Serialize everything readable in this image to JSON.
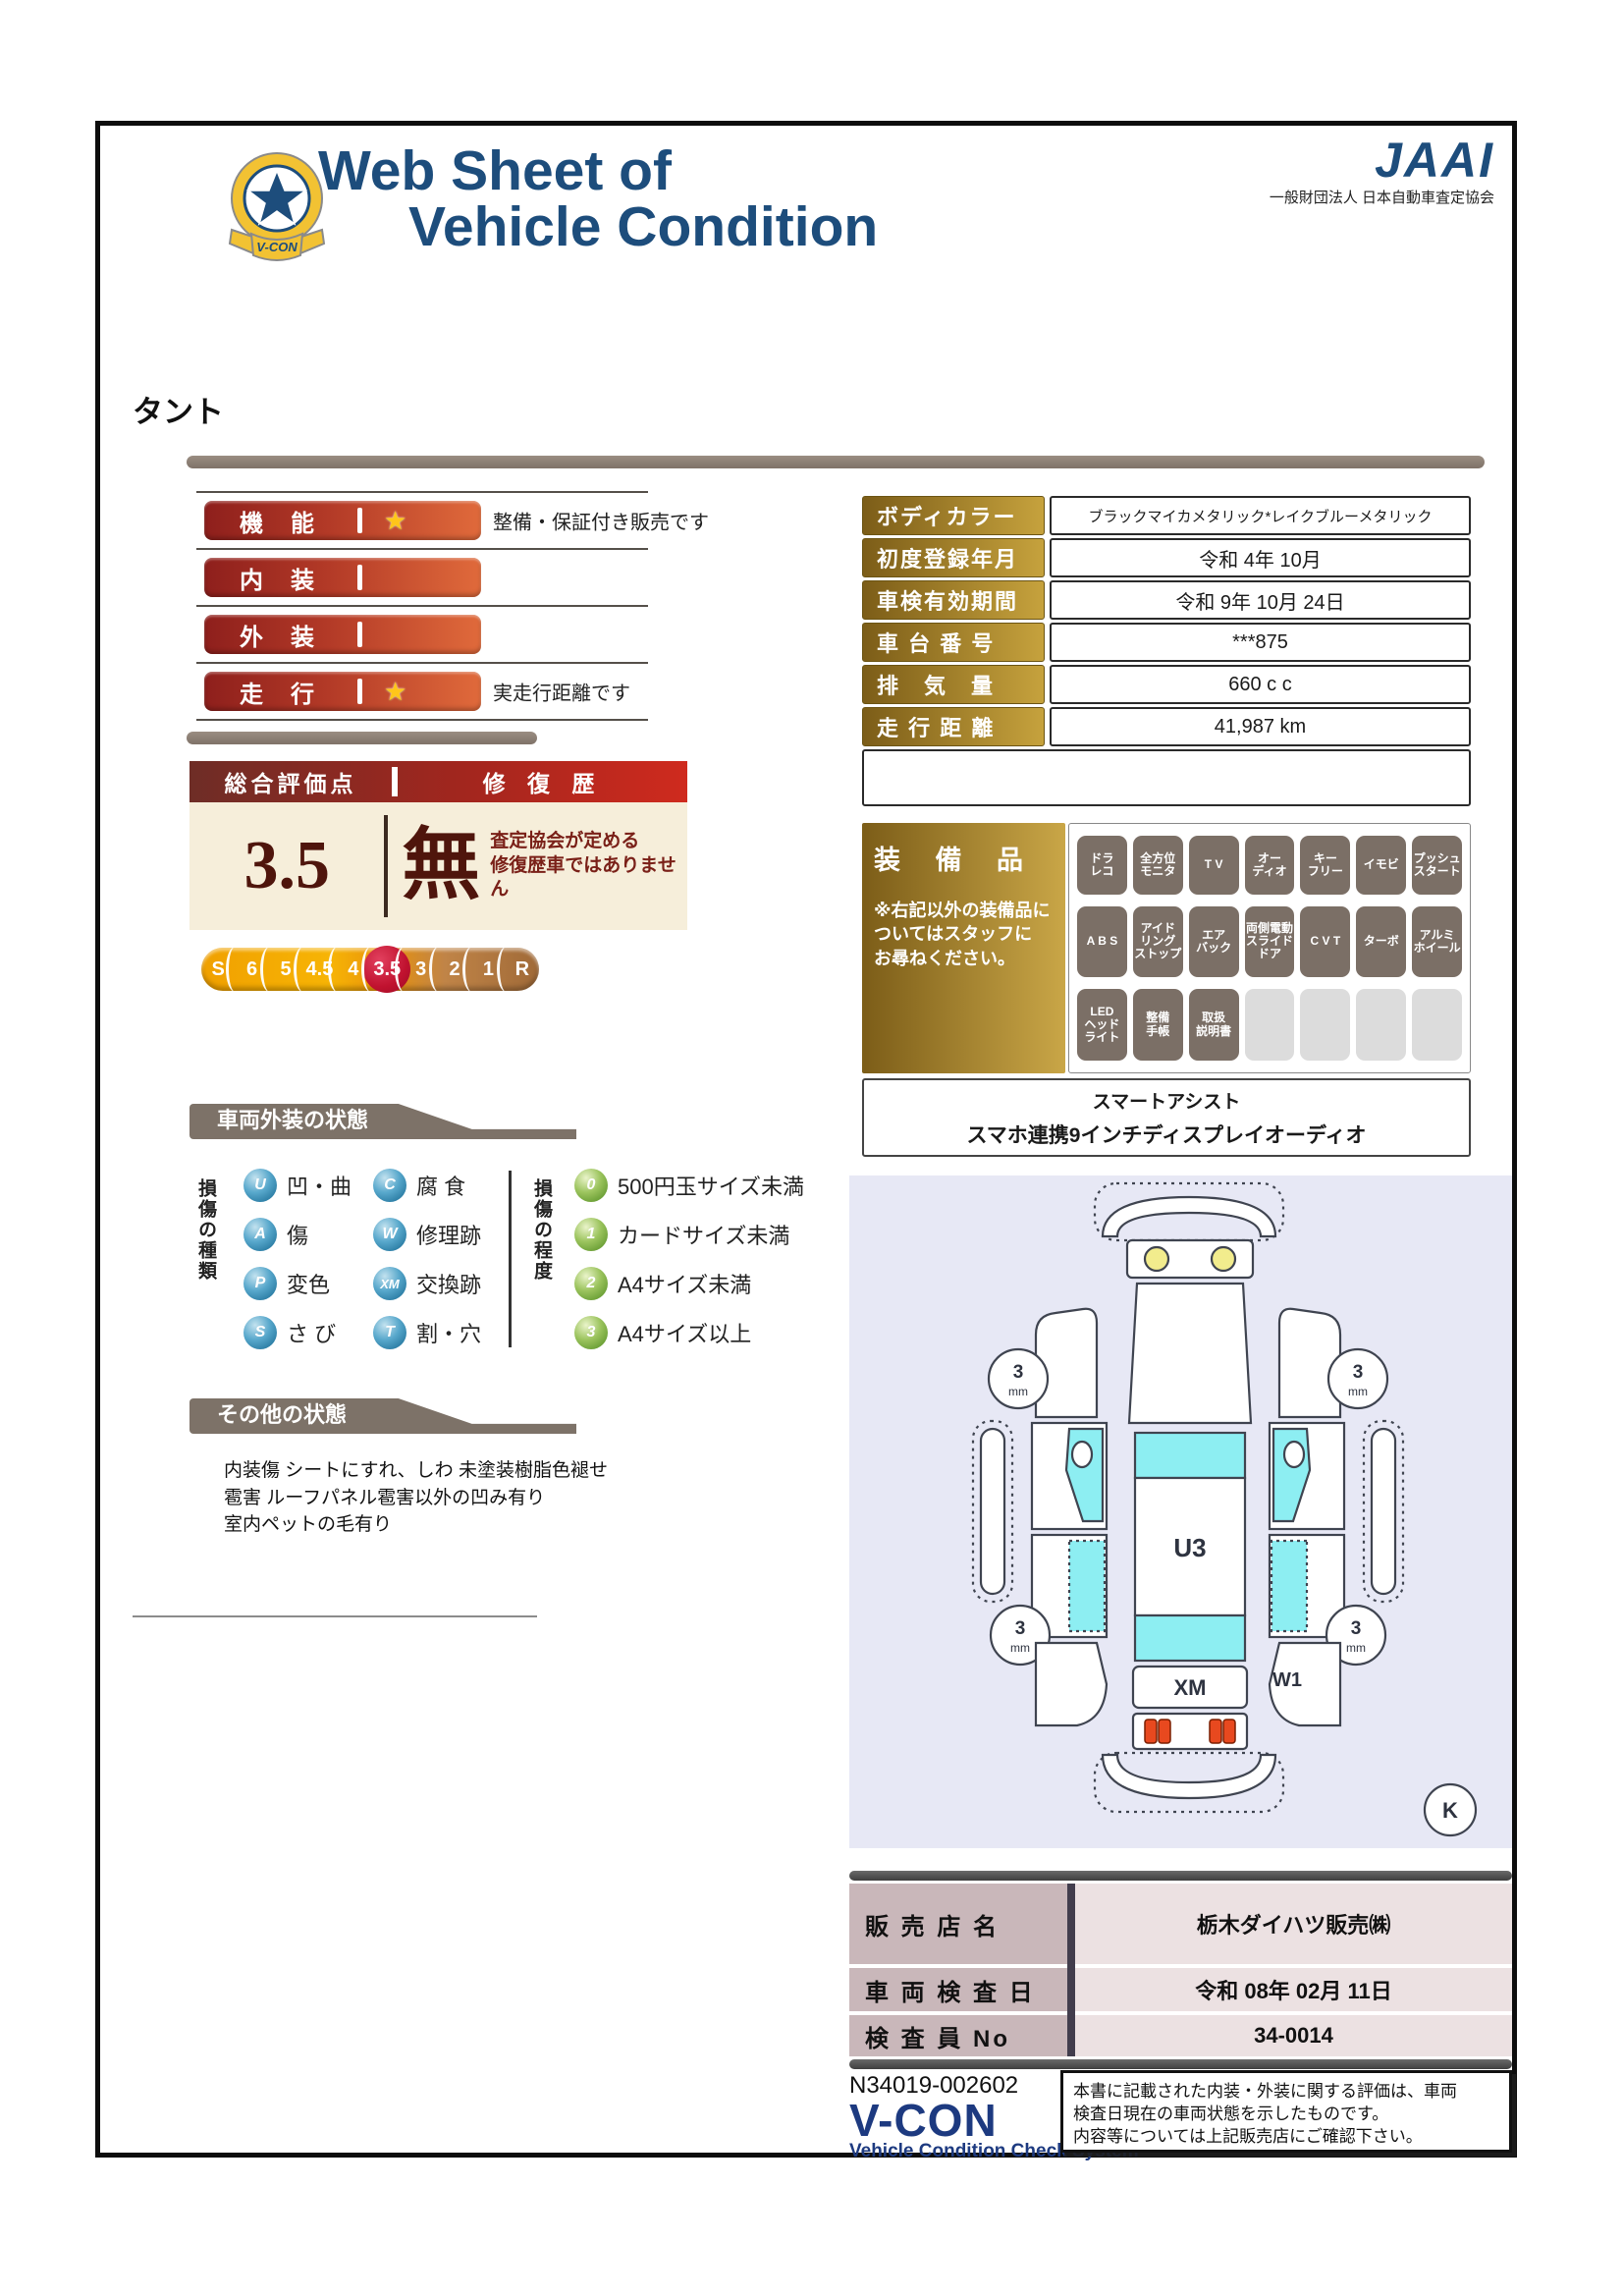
{
  "header": {
    "title_line1": "Web Sheet of",
    "title_line2": "Vehicle Condition",
    "vcon_badge": "V-CON",
    "jaai_logo": "JAAI",
    "jaai_org": "一般財団法人 日本自動車査定協会"
  },
  "vehicle_name": "タント",
  "ratings": {
    "rows": [
      {
        "label": "機　能",
        "star": "★",
        "note": "整備・保証付き販売です"
      },
      {
        "label": "内　装",
        "star": "",
        "note": ""
      },
      {
        "label": "外　装",
        "star": "",
        "note": ""
      },
      {
        "label": "走　行",
        "star": "★",
        "note": "実走行距離です"
      }
    ]
  },
  "overall": {
    "header_left": "総合評価点",
    "header_right": "修 復 歴",
    "score": "3.5",
    "repair_flag": "無",
    "repair_note": "査定協会が定める\n修復歴車ではありません",
    "scale": [
      "S",
      "6",
      "5",
      "4.5",
      "4",
      "3.5",
      "3",
      "2",
      "1",
      "R"
    ],
    "scale_selected": "3.5"
  },
  "details": {
    "rows": [
      {
        "label": "ボディカラー",
        "value": "ブラックマイカメタリック*レイクブルーメタリック"
      },
      {
        "label": "初度登録年月",
        "value": "令和 4年 10月"
      },
      {
        "label": "車検有効期間",
        "value": "令和 9年 10月 24日"
      },
      {
        "label": "車 台 番 号",
        "value": "***875"
      },
      {
        "label": "排　気　量",
        "value": "660 c c"
      },
      {
        "label": "走 行 距 離",
        "value": "41,987 km"
      }
    ]
  },
  "equipment": {
    "title": "装 備 品",
    "note": "※右記以外の装備品に\nついてはスタッフに\nお尋ねください。",
    "badges": [
      "ドラ\nレコ",
      "全方位\nモニタ",
      "T V",
      "オー\nディオ",
      "キー\nフリー",
      "イモビ",
      "プッシュ\nスタート",
      "A B S",
      "アイド\nリング\nストップ",
      "エア\nバック",
      "両側電動\nスライド\nドア",
      "C V T",
      "ターボ",
      "アルミ\nホイール",
      "LED\nヘッド\nライト",
      "整備\n手帳",
      "取扱\n説明書",
      "",
      "",
      "",
      ""
    ],
    "extra_line1": "スマートアシスト",
    "extra_line2": "スマホ連携9インチディスプレイオーディオ"
  },
  "exterior_section": {
    "title": "車両外装の状態",
    "type_label": "損傷の種類",
    "types": [
      {
        "code": "U",
        "label": "凹・曲"
      },
      {
        "code": "A",
        "label": "傷"
      },
      {
        "code": "P",
        "label": "変色"
      },
      {
        "code": "S",
        "label": "さ び"
      },
      {
        "code": "C",
        "label": "腐 食"
      },
      {
        "code": "W",
        "label": "修理跡"
      },
      {
        "code": "XM",
        "label": "交換跡"
      },
      {
        "code": "T",
        "label": "割・穴"
      }
    ],
    "degree_label": "損傷の程度",
    "degrees": [
      {
        "code": "0",
        "label": "500円玉サイズ未満"
      },
      {
        "code": "1",
        "label": "カードサイズ未満"
      },
      {
        "code": "2",
        "label": "A4サイズ未満"
      },
      {
        "code": "3",
        "label": "A4サイズ以上"
      }
    ]
  },
  "other_section": {
    "title": "その他の状態",
    "text": "内装傷 シートにすれ、しわ 未塗装樹脂色褪せ\n雹害 ルーフパネル雹害以外の凹み有り\n室内ペットの毛有り"
  },
  "diagram": {
    "roof_mark": "U3",
    "rear_mark": "XM",
    "quarter_mark": "W1",
    "tires": [
      "3",
      "3",
      "3",
      "3"
    ],
    "tire_unit": "mm",
    "corner_mark": "K"
  },
  "sales": {
    "rows": [
      {
        "label": "販 売 店 名",
        "value": "栃木ダイハツ販売㈱"
      },
      {
        "label": "車 両 検 査 日",
        "value": "令和 08年 02月 11日"
      },
      {
        "label": "検 査 員 No",
        "value": "34-0014"
      }
    ]
  },
  "footer": {
    "doc_no": "N34019-002602",
    "vcon": "V-CON",
    "vcon_sub": "Vehicle Condition Check System",
    "disclaimer": "本書に記載された内装・外装に関する評価は、車両\n検査日現在の車両状態を示したものです。\n内容等については上記販売店にご確認下さい。"
  },
  "colors": {
    "navy": "#1d4d7c",
    "maroon": "#4f150c",
    "gold_label": "#c6a23d",
    "scale_selected": "#c0122f",
    "banner": "#7d7268",
    "window_cyan": "#8deef2"
  }
}
